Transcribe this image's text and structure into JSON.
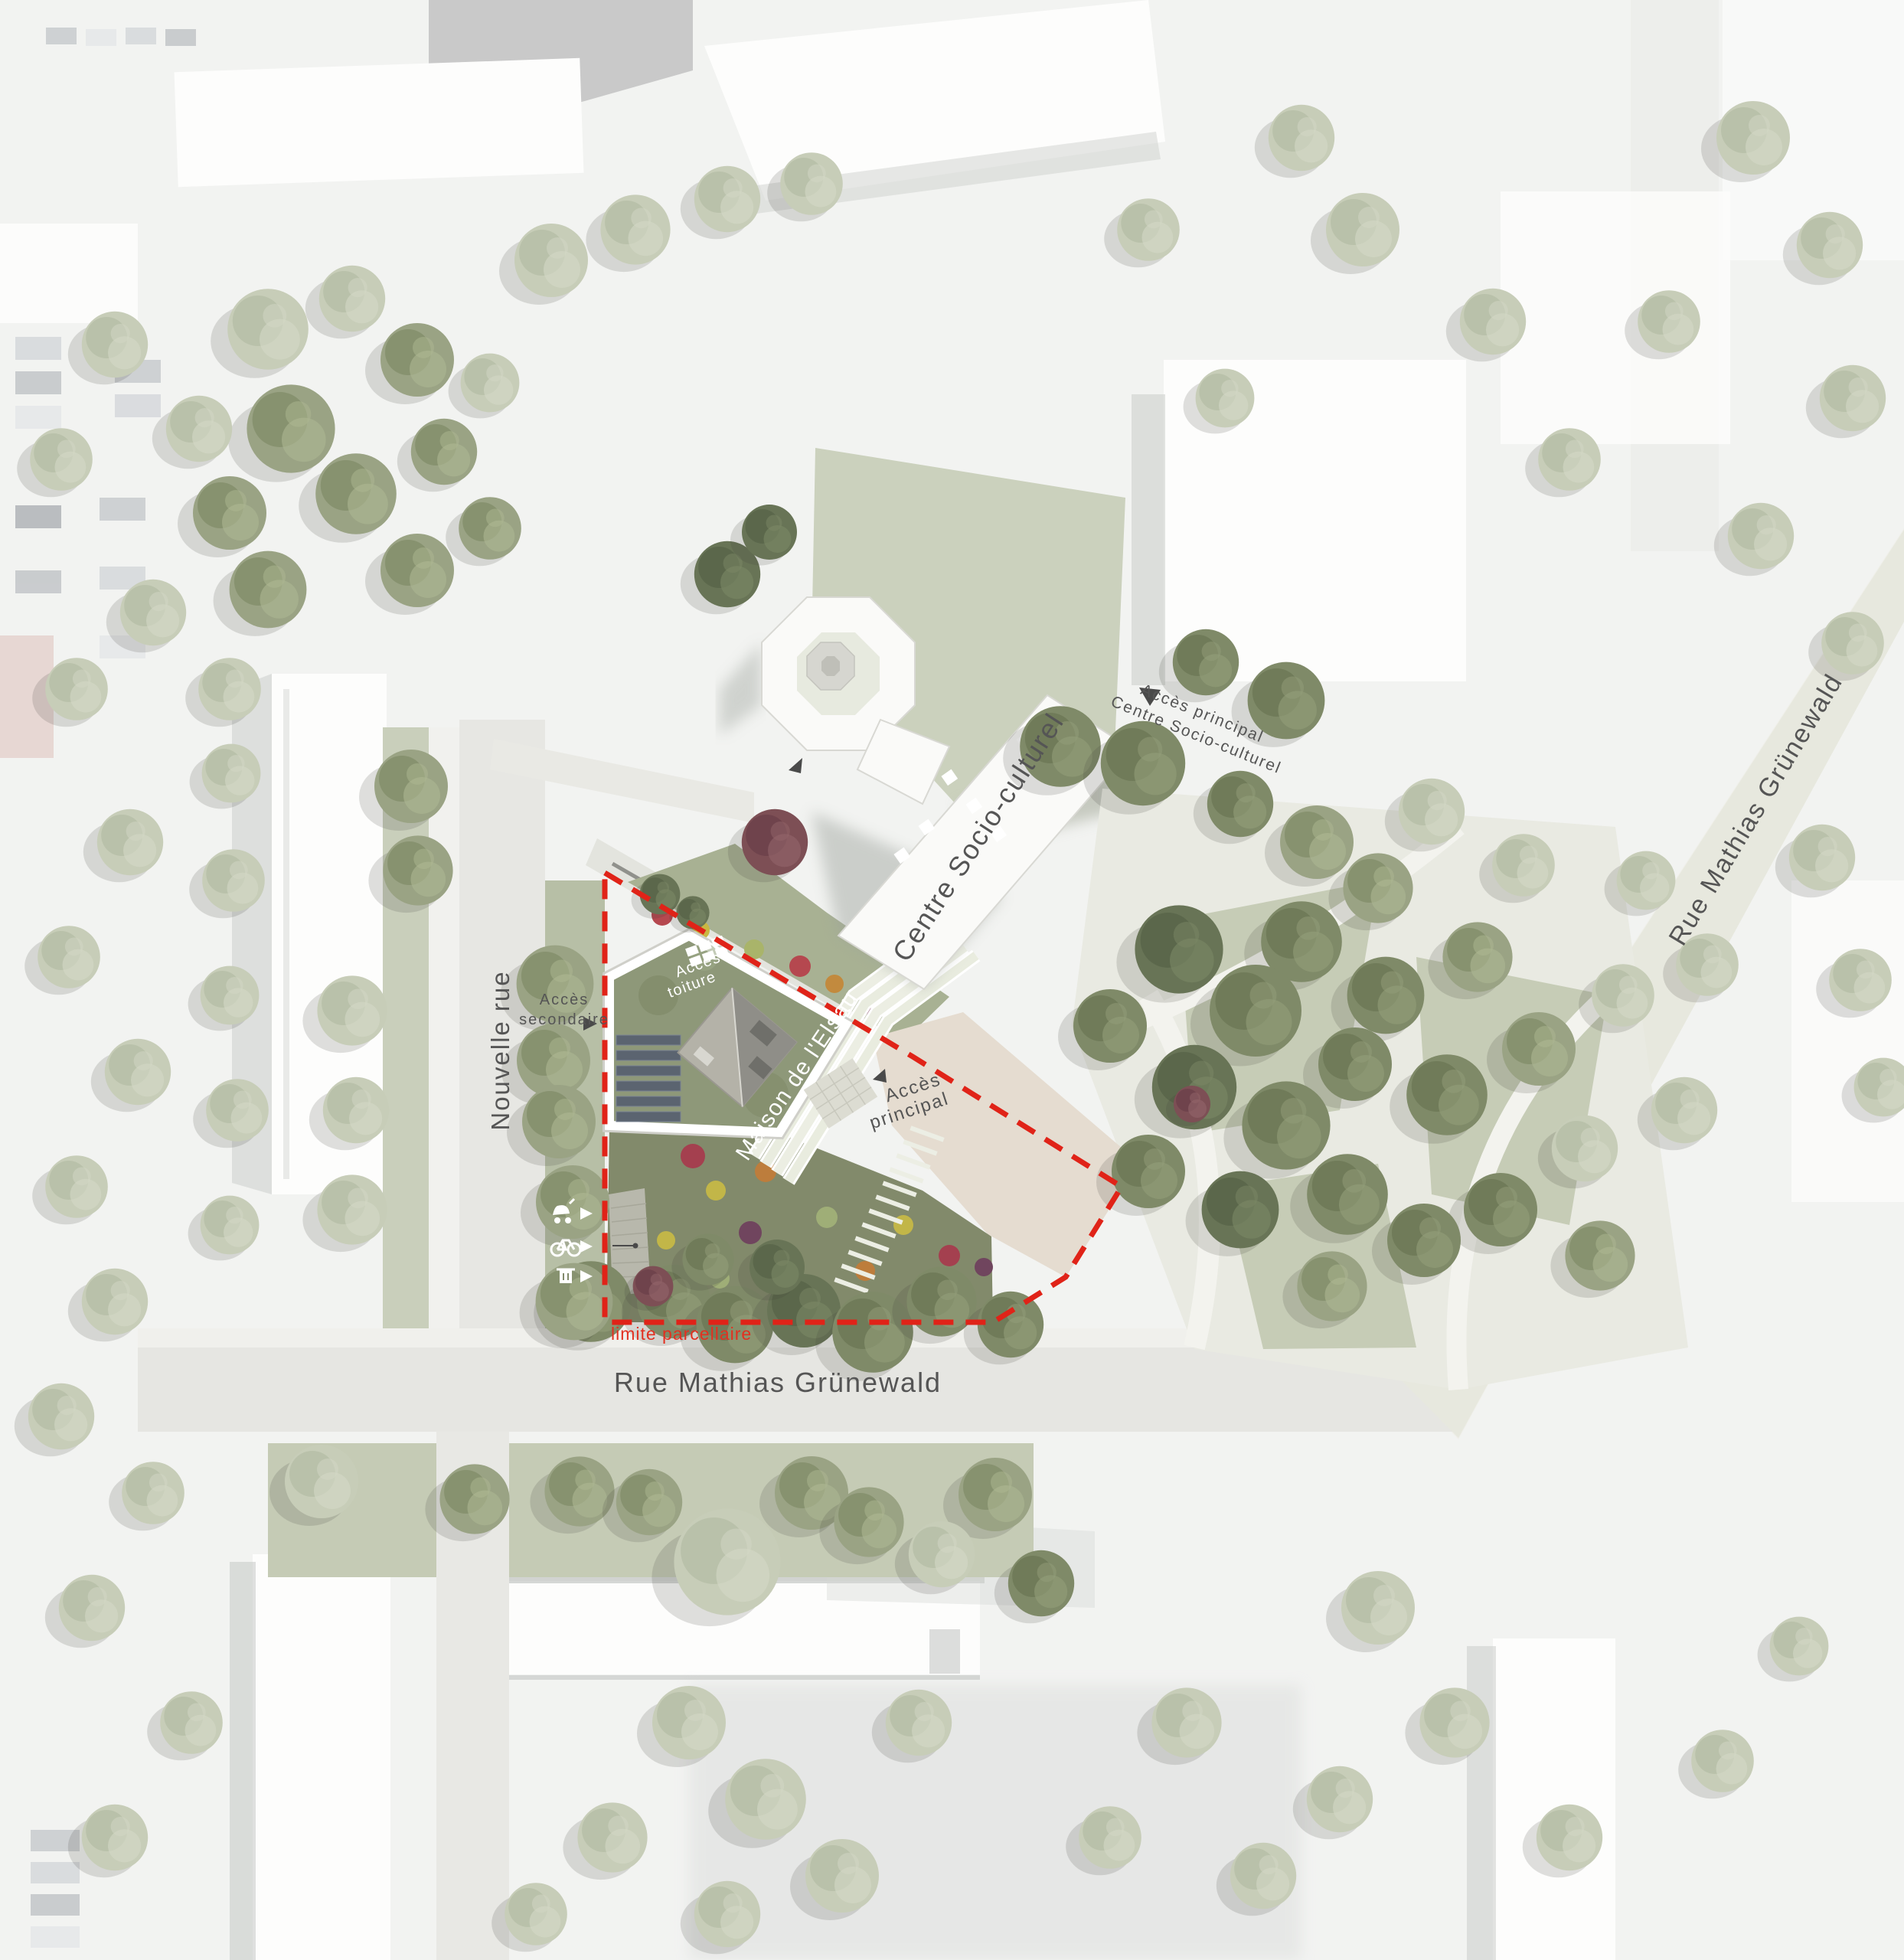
{
  "map": {
    "type": "architectural-site-plan",
    "labels": {
      "centre_socio_culturel": "Centre Socio-culturel",
      "acces_principal_centre": {
        "line1": "Accès principal",
        "line2": "Centre Socio-culturel"
      },
      "rue_mathias_grunewald_diagonal": "Rue Mathias Grünewald",
      "rue_mathias_grunewald_horizontal": "Rue Mathias Grünewald",
      "nouvelle_rue": "Nouvelle rue",
      "acces_secondaire": {
        "line1": "Accès",
        "line2": "secondaire"
      },
      "acces_toiture": {
        "line1": "Accès",
        "line2": "toiture"
      },
      "maison_de_l_elsau": "Maison de l'Elsau",
      "acces_principal_parcelle": {
        "line1": "Accès",
        "line2": "principal"
      },
      "limite_parcellaire": "limite parcellaire"
    },
    "icons": [
      {
        "name": "stroller-icon"
      },
      {
        "name": "bicycle-icon"
      },
      {
        "name": "trash-bin-icon"
      },
      {
        "name": "arrow-right-triangle"
      },
      {
        "name": "access-marker-triangle"
      },
      {
        "name": "roof-access-grid-icon"
      }
    ],
    "colors": {
      "parcel_boundary_red": "#e02318",
      "limite_text_red": "#e23020",
      "label_gray": "#555555",
      "white_building": "#fafaf8",
      "green_roof": "#8e9879",
      "solar_panel": "#5b6470",
      "plaza_sand": "#e5dcd0",
      "park_grass": "#c6ccb6",
      "street": "#e7e7e3",
      "garden_green": "#828a6b"
    }
  }
}
